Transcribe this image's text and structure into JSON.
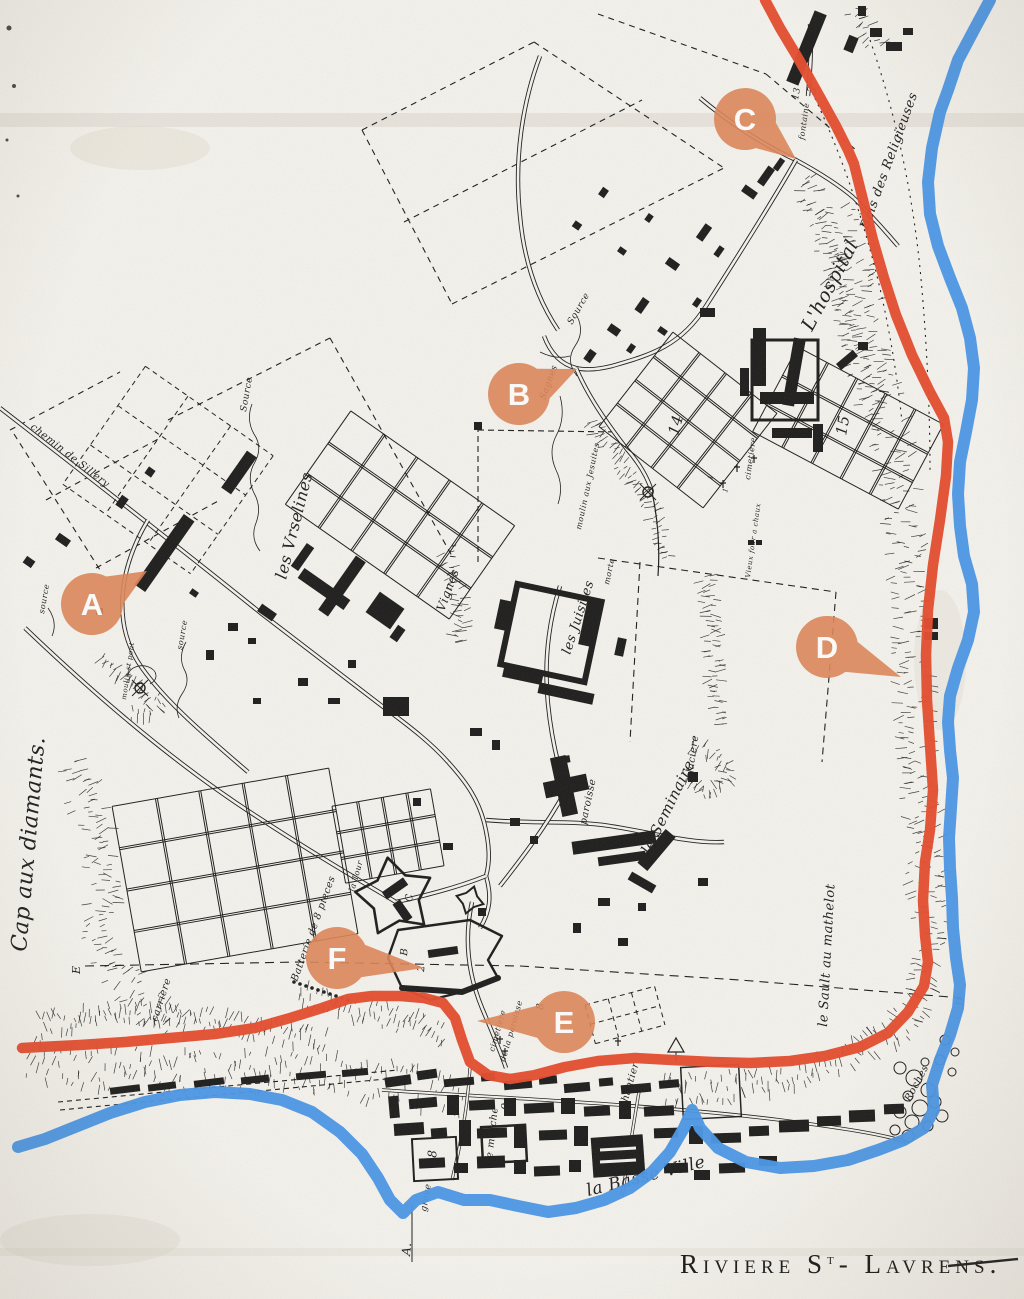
{
  "colors": {
    "paper": "#f6f4ef",
    "ink": "#1b1b1b",
    "route": "#e64a2b",
    "river": "#4896e8",
    "marker_fill": "#df8557",
    "marker_letter": "#ffffff"
  },
  "title": {
    "prefix": "Riviere S",
    "sup": "t",
    "suffix": "- Lavrens.",
    "x": 680,
    "y": 1273
  },
  "markers": [
    {
      "letter": "A",
      "cx": 92,
      "cy": 604,
      "tx": 147,
      "ty": 571
    },
    {
      "letter": "B",
      "cx": 519,
      "cy": 394,
      "tx": 577,
      "ty": 369
    },
    {
      "letter": "C",
      "cx": 745,
      "cy": 119,
      "tx": 796,
      "ty": 159
    },
    {
      "letter": "D",
      "cx": 827,
      "cy": 647,
      "tx": 901,
      "ty": 677
    },
    {
      "letter": "E",
      "cx": 564,
      "cy": 1022,
      "tx": 477,
      "ty": 1021
    },
    {
      "letter": "F",
      "cx": 337,
      "cy": 958,
      "tx": 424,
      "ty": 968
    }
  ],
  "labels": [
    {
      "t": "Cap aux diamants.",
      "x": 26,
      "y": 952,
      "r": -85,
      "s": 22
    },
    {
      "t": "chemin de Sillery",
      "x": 30,
      "y": 428,
      "r": 38,
      "s": 10
    },
    {
      "t": "Source",
      "x": 246,
      "y": 412,
      "r": -80,
      "s": 9
    },
    {
      "t": "les Vrselines",
      "x": 286,
      "y": 580,
      "r": -76,
      "s": 16
    },
    {
      "t": "Vignes",
      "x": 444,
      "y": 612,
      "r": -70,
      "s": 12
    },
    {
      "t": "Source",
      "x": 572,
      "y": 325,
      "r": -60,
      "s": 9
    },
    {
      "t": "Sagnes",
      "x": 545,
      "y": 400,
      "r": -70,
      "s": 9
    },
    {
      "t": "morte",
      "x": 609,
      "y": 585,
      "r": -78,
      "s": 8
    },
    {
      "t": "moulin aux Jesuites",
      "x": 581,
      "y": 530,
      "r": -78,
      "s": 8
    },
    {
      "t": "les Juisites",
      "x": 570,
      "y": 655,
      "r": -72,
      "s": 13
    },
    {
      "t": "L'hospital",
      "x": 812,
      "y": 332,
      "r": -62,
      "s": 19
    },
    {
      "t": "Bois des Religieuses",
      "x": 868,
      "y": 230,
      "r": -70,
      "s": 13
    },
    {
      "t": "fontaine",
      "x": 804,
      "y": 140,
      "r": -82,
      "s": 8
    },
    {
      "t": "13",
      "x": 798,
      "y": 100,
      "r": -80,
      "s": 9
    },
    {
      "t": "3",
      "x": 814,
      "y": 96,
      "r": -62,
      "s": 13
    },
    {
      "t": "14",
      "x": 678,
      "y": 436,
      "r": -75,
      "s": 15
    },
    {
      "t": "15",
      "x": 846,
      "y": 436,
      "r": -80,
      "s": 15
    },
    {
      "t": "cimetiere",
      "x": 750,
      "y": 480,
      "r": -82,
      "s": 8
    },
    {
      "t": "1",
      "x": 712,
      "y": 480,
      "r": -75,
      "s": 7
    },
    {
      "t": "1",
      "x": 727,
      "y": 493,
      "r": -75,
      "s": 7
    },
    {
      "t": "Vieux four a chaux",
      "x": 750,
      "y": 578,
      "r": -82,
      "s": 7
    },
    {
      "t": "glaciere",
      "x": 692,
      "y": 780,
      "r": -82,
      "s": 10
    },
    {
      "t": "paroisse",
      "x": 586,
      "y": 825,
      "r": -78,
      "s": 10
    },
    {
      "t": "le Seminaire",
      "x": 650,
      "y": 855,
      "r": -64,
      "s": 15
    },
    {
      "t": "le Sault au mathelot",
      "x": 827,
      "y": 1027,
      "r": -87,
      "s": 13
    },
    {
      "t": "source",
      "x": 182,
      "y": 650,
      "r": -80,
      "s": 8
    },
    {
      "t": "source",
      "x": 44,
      "y": 614,
      "r": -80,
      "s": 8
    },
    {
      "t": "moulin st pont",
      "x": 126,
      "y": 700,
      "r": -82,
      "s": 7
    },
    {
      "t": "carriere",
      "x": 157,
      "y": 1022,
      "r": -72,
      "s": 10
    },
    {
      "t": "la Tour",
      "x": 354,
      "y": 892,
      "r": -74,
      "s": 8
    },
    {
      "t": "Batterie de 8 pieces",
      "x": 297,
      "y": 982,
      "r": -70,
      "s": 10
    },
    {
      "t": "C",
      "x": 412,
      "y": 902,
      "r": -85,
      "s": 10
    },
    {
      "t": "B",
      "x": 407,
      "y": 956,
      "r": -85,
      "s": 10
    },
    {
      "t": "2",
      "x": 424,
      "y": 972,
      "r": -85,
      "s": 10
    },
    {
      "t": "cimetiere",
      "x": 494,
      "y": 1052,
      "r": -74,
      "s": 8
    },
    {
      "t": "de la paroisse",
      "x": 505,
      "y": 1062,
      "r": -74,
      "s": 8
    },
    {
      "t": "8",
      "x": 543,
      "y": 1010,
      "r": -85,
      "s": 10
    },
    {
      "t": "chantier",
      "x": 626,
      "y": 1108,
      "r": -74,
      "s": 10
    },
    {
      "t": "9",
      "x": 509,
      "y": 1110,
      "r": -88,
      "s": 11
    },
    {
      "t": "le marche",
      "x": 492,
      "y": 1162,
      "r": -84,
      "s": 10
    },
    {
      "t": "18",
      "x": 436,
      "y": 1166,
      "r": -88,
      "s": 12
    },
    {
      "t": "greve",
      "x": 426,
      "y": 1212,
      "r": -80,
      "s": 9
    },
    {
      "t": "la Basse Ville",
      "x": 588,
      "y": 1196,
      "r": -14,
      "s": 17
    },
    {
      "t": "Roches",
      "x": 910,
      "y": 1102,
      "r": -62,
      "s": 10
    },
    {
      "t": "E",
      "x": 80,
      "y": 974,
      "r": -90,
      "s": 11
    },
    {
      "t": "D",
      "x": 964,
      "y": 1006,
      "r": -90,
      "s": 11
    },
    {
      "t": "A.",
      "x": 410,
      "y": 1256,
      "r": -85,
      "s": 12
    }
  ],
  "route_red": [
    [
      765,
      0
    ],
    [
      780,
      28
    ],
    [
      798,
      58
    ],
    [
      816,
      90
    ],
    [
      836,
      126
    ],
    [
      848,
      150
    ],
    [
      854,
      164
    ],
    [
      863,
      200
    ],
    [
      873,
      240
    ],
    [
      884,
      278
    ],
    [
      896,
      315
    ],
    [
      912,
      355
    ],
    [
      930,
      392
    ],
    [
      944,
      418
    ],
    [
      948,
      442
    ],
    [
      946,
      476
    ],
    [
      940,
      520
    ],
    [
      933,
      565
    ],
    [
      928,
      610
    ],
    [
      926,
      655
    ],
    [
      927,
      700
    ],
    [
      930,
      745
    ],
    [
      933,
      790
    ],
    [
      930,
      830
    ],
    [
      925,
      862
    ],
    [
      923,
      900
    ],
    [
      925,
      935
    ],
    [
      928,
      962
    ],
    [
      924,
      986
    ],
    [
      908,
      1012
    ],
    [
      888,
      1033
    ],
    [
      860,
      1047
    ],
    [
      825,
      1056
    ],
    [
      790,
      1061
    ],
    [
      750,
      1063
    ],
    [
      713,
      1062
    ],
    [
      672,
      1060
    ],
    [
      635,
      1058
    ],
    [
      598,
      1061
    ],
    [
      565,
      1067
    ],
    [
      535,
      1075
    ],
    [
      510,
      1079
    ],
    [
      488,
      1075
    ],
    [
      470,
      1062
    ],
    [
      462,
      1040
    ],
    [
      455,
      1018
    ],
    [
      443,
      1003
    ],
    [
      424,
      998
    ],
    [
      400,
      996
    ],
    [
      372,
      996
    ],
    [
      348,
      999
    ],
    [
      322,
      1008
    ],
    [
      290,
      1018
    ],
    [
      255,
      1028
    ],
    [
      215,
      1034
    ],
    [
      170,
      1038
    ],
    [
      125,
      1042
    ],
    [
      80,
      1045
    ],
    [
      40,
      1047
    ],
    [
      22,
      1048
    ]
  ],
  "river_blue": [
    [
      990,
      0
    ],
    [
      975,
      28
    ],
    [
      958,
      60
    ],
    [
      948,
      90
    ],
    [
      940,
      112
    ],
    [
      932,
      148
    ],
    [
      928,
      182
    ],
    [
      930,
      214
    ],
    [
      938,
      246
    ],
    [
      950,
      278
    ],
    [
      962,
      308
    ],
    [
      970,
      338
    ],
    [
      974,
      368
    ],
    [
      972,
      400
    ],
    [
      966,
      432
    ],
    [
      960,
      462
    ],
    [
      958,
      494
    ],
    [
      960,
      526
    ],
    [
      964,
      556
    ],
    [
      972,
      584
    ],
    [
      974,
      612
    ],
    [
      968,
      640
    ],
    [
      958,
      668
    ],
    [
      950,
      696
    ],
    [
      948,
      722
    ],
    [
      950,
      750
    ],
    [
      953,
      778
    ],
    [
      951,
      808
    ],
    [
      949,
      838
    ],
    [
      950,
      868
    ],
    [
      952,
      898
    ],
    [
      953,
      928
    ],
    [
      956,
      958
    ],
    [
      960,
      985
    ],
    [
      958,
      1008
    ],
    [
      950,
      1035
    ],
    [
      940,
      1060
    ],
    [
      932,
      1085
    ],
    [
      934,
      1110
    ],
    [
      924,
      1128
    ],
    [
      904,
      1140
    ],
    [
      878,
      1150
    ],
    [
      848,
      1160
    ],
    [
      814,
      1166
    ],
    [
      780,
      1168
    ],
    [
      746,
      1162
    ],
    [
      718,
      1148
    ],
    [
      700,
      1128
    ],
    [
      692,
      1110
    ],
    [
      684,
      1128
    ],
    [
      670,
      1152
    ],
    [
      652,
      1172
    ],
    [
      630,
      1188
    ],
    [
      604,
      1200
    ],
    [
      576,
      1208
    ],
    [
      548,
      1212
    ],
    [
      518,
      1206
    ],
    [
      490,
      1200
    ],
    [
      464,
      1200
    ],
    [
      438,
      1192
    ],
    [
      416,
      1200
    ],
    [
      403,
      1213
    ],
    [
      390,
      1200
    ],
    [
      378,
      1178
    ],
    [
      362,
      1154
    ],
    [
      340,
      1132
    ],
    [
      312,
      1112
    ],
    [
      282,
      1100
    ],
    [
      250,
      1094
    ],
    [
      215,
      1092
    ],
    [
      180,
      1095
    ],
    [
      145,
      1102
    ],
    [
      110,
      1113
    ],
    [
      75,
      1127
    ],
    [
      45,
      1139
    ],
    [
      18,
      1147
    ]
  ]
}
